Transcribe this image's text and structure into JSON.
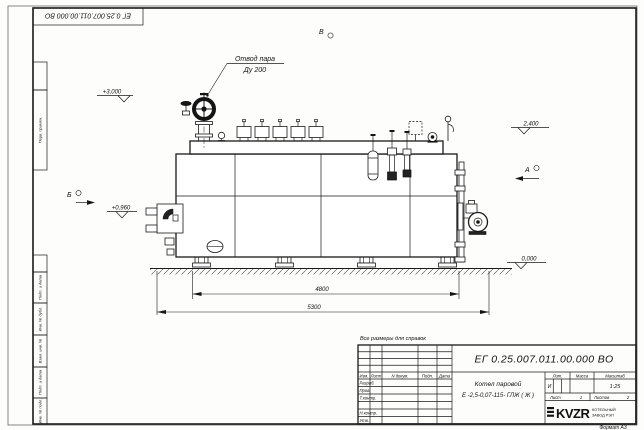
{
  "colors": {
    "line": "#1a1a1a",
    "paper": "#fdfdfc",
    "fill_dark": "#141414"
  },
  "drawing": {
    "corner_stamp": "ЕГ 0.25.007.011.00.000 ВО",
    "note": "Все размеры для справок",
    "labels": {
      "steam_outlet_1": "Отвод пара",
      "steam_outlet_2": "Ду 200"
    },
    "elevations": {
      "top": "+3,000",
      "right": "2,400",
      "burner": "+0,960",
      "ground": "0,000"
    },
    "views": {
      "a": "А",
      "b": "Б",
      "v": "В"
    },
    "dimensions": {
      "supports_length": "4800",
      "overall_length": "5300"
    }
  },
  "margin_stamps": {
    "items": [
      "Перв. примен.",
      "Подп. и дата",
      "Инв. № дубл.",
      "Взам. инв. №",
      "Подп. и дата",
      "Инв. № подл."
    ]
  },
  "title_block": {
    "doc_number": "ЕГ 0.25.007.011.00.000 ВО",
    "product_name_1": "Котел паровой",
    "product_name_2": "Е -2,5-0,07-115- ГЛЖ ( Ж )",
    "cols": {
      "izm": "Изм.",
      "list": "Лист",
      "doc": "N докум.",
      "sign": "Подп.",
      "date": "Дата"
    },
    "rows": {
      "developed": "Разраб.",
      "checked": "Пров.",
      "tcontrol": "Т.контр.",
      "ncontrol": "Н.контр.",
      "approved": "Утв."
    },
    "lit_header": "Лит.",
    "mass_header": "Масса",
    "scale_header": "Масштаб",
    "lit_value": "И",
    "scale_value": "1:25",
    "sheet_label": "Лист",
    "sheet_value": "1",
    "sheets_label": "Листов",
    "sheets_value": "2",
    "logo": "KVZR",
    "logo_sub_1": "КОТЕЛЬНЫЙ",
    "logo_sub_2": "ЗАВОД РЭП",
    "format": "Формат А3"
  }
}
